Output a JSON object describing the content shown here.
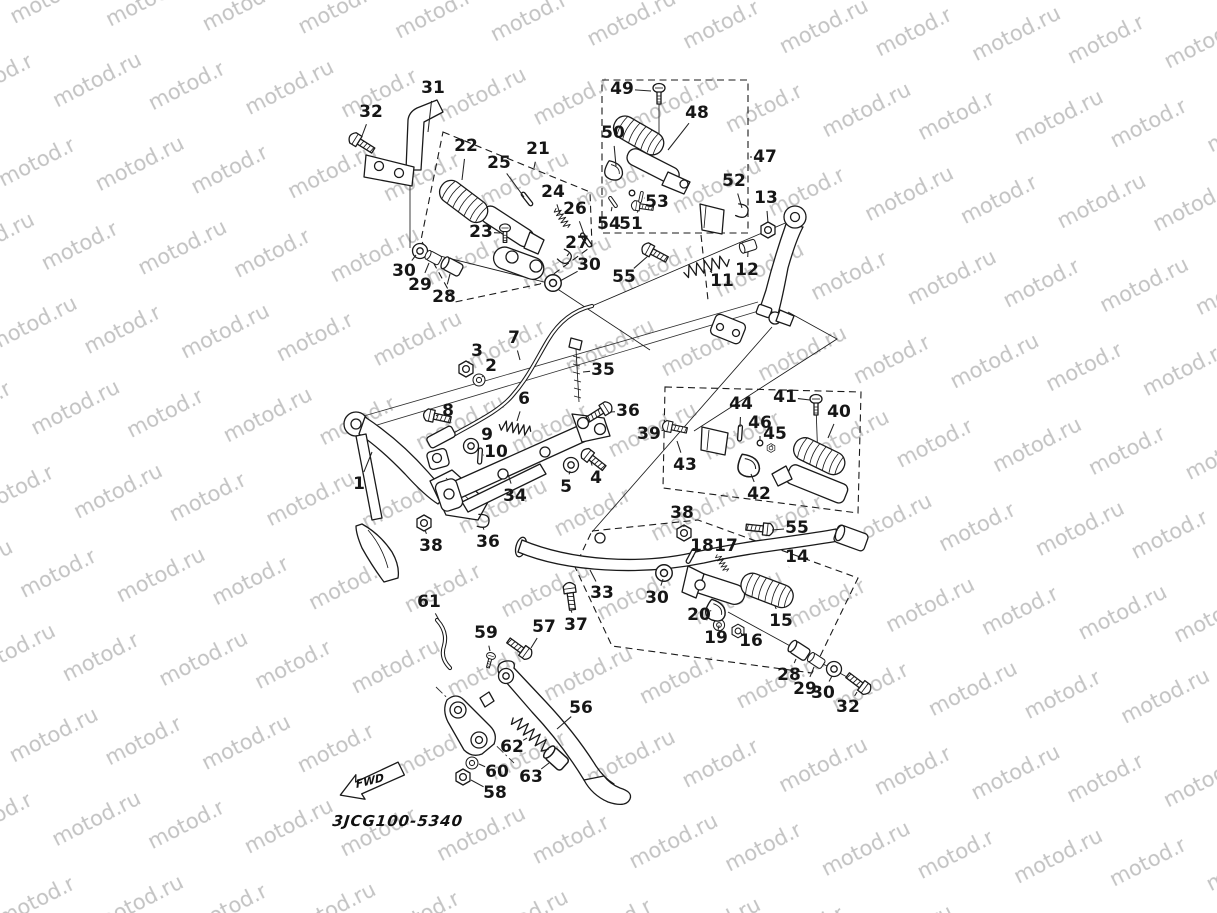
{
  "meta": {
    "description": "Exploded motorcycle parts diagram: stand and footrest assembly",
    "canvas_width": 1217,
    "canvas_height": 913
  },
  "watermark": {
    "text": "motod.ru",
    "color": "#c3c3c3"
  },
  "footer": {
    "drawing_code": "3JCG100-5340",
    "fwd_label": "FWD"
  },
  "diagram": {
    "callouts": [
      {
        "id": "31",
        "n": "31",
        "x": 433,
        "y": 88,
        "tx": 428,
        "ty": 132
      },
      {
        "id": "32a",
        "n": "32",
        "x": 371,
        "y": 112,
        "tx": 362,
        "ty": 136
      },
      {
        "id": "49",
        "n": "49",
        "x": 622,
        "y": 89,
        "tx": 651,
        "ty": 91
      },
      {
        "id": "48",
        "n": "48",
        "x": 697,
        "y": 113,
        "tx": 668,
        "ty": 150
      },
      {
        "id": "50",
        "n": "50",
        "x": 613,
        "y": 133,
        "tx": 616,
        "ty": 166
      },
      {
        "id": "47",
        "n": "47",
        "x": 765,
        "y": 157,
        "tx": 750,
        "ty": 157
      },
      {
        "id": "22",
        "n": "22",
        "x": 466,
        "y": 146,
        "tx": 462,
        "ty": 180
      },
      {
        "id": "25",
        "n": "25",
        "x": 499,
        "y": 163,
        "tx": 524,
        "ty": 197
      },
      {
        "id": "21",
        "n": "21",
        "x": 538,
        "y": 149,
        "tx": 534,
        "ty": 168
      },
      {
        "id": "24",
        "n": "24",
        "x": 553,
        "y": 192,
        "tx": 560,
        "ty": 214
      },
      {
        "id": "26",
        "n": "26",
        "x": 575,
        "y": 209,
        "tx": 585,
        "ty": 237
      },
      {
        "id": "52",
        "n": "52",
        "x": 734,
        "y": 181,
        "tx": 742,
        "ty": 208
      },
      {
        "id": "13",
        "n": "13",
        "x": 766,
        "y": 198,
        "tx": 768,
        "ty": 223
      },
      {
        "id": "53",
        "n": "53",
        "x": 657,
        "y": 202,
        "tx": 644,
        "ty": 198
      },
      {
        "id": "54",
        "n": "54",
        "x": 609,
        "y": 224,
        "tx": 612,
        "ty": 207
      },
      {
        "id": "51",
        "n": "51",
        "x": 631,
        "y": 224,
        "tx": 638,
        "ty": 211
      },
      {
        "id": "23",
        "n": "23",
        "x": 481,
        "y": 232,
        "tx": 500,
        "ty": 233
      },
      {
        "id": "27",
        "n": "27",
        "x": 577,
        "y": 243,
        "tx": 567,
        "ty": 256
      },
      {
        "id": "30a",
        "n": "30",
        "x": 404,
        "y": 271,
        "tx": 416,
        "ty": 255
      },
      {
        "id": "29a",
        "n": "29",
        "x": 420,
        "y": 285,
        "tx": 429,
        "ty": 263
      },
      {
        "id": "28a",
        "n": "28",
        "x": 444,
        "y": 297,
        "tx": 450,
        "ty": 274
      },
      {
        "id": "30b",
        "n": "30",
        "x": 589,
        "y": 265,
        "tx": 560,
        "ty": 281
      },
      {
        "id": "55a",
        "n": "55",
        "x": 624,
        "y": 277,
        "tx": 648,
        "ty": 256
      },
      {
        "id": "11",
        "n": "11",
        "x": 722,
        "y": 281,
        "tx": 710,
        "ty": 271
      },
      {
        "id": "12",
        "n": "12",
        "x": 747,
        "y": 270,
        "tx": 748,
        "ty": 252
      },
      {
        "id": "3",
        "n": "3",
        "x": 477,
        "y": 351,
        "tx": 468,
        "ty": 363
      },
      {
        "id": "2",
        "n": "2",
        "x": 491,
        "y": 366,
        "tx": 482,
        "ty": 377
      },
      {
        "id": "7",
        "n": "7",
        "x": 514,
        "y": 338,
        "tx": 520,
        "ty": 360
      },
      {
        "id": "35",
        "n": "35",
        "x": 603,
        "y": 370,
        "tx": 583,
        "ty": 372
      },
      {
        "id": "8",
        "n": "8",
        "x": 448,
        "y": 411,
        "tx": 438,
        "ty": 415
      },
      {
        "id": "6",
        "n": "6",
        "x": 524,
        "y": 399,
        "tx": 517,
        "ty": 421
      },
      {
        "id": "36a",
        "n": "36",
        "x": 628,
        "y": 411,
        "tx": 610,
        "ty": 412
      },
      {
        "id": "9",
        "n": "9",
        "x": 487,
        "y": 435,
        "tx": 477,
        "ty": 443
      },
      {
        "id": "10",
        "n": "10",
        "x": 496,
        "y": 452,
        "tx": 484,
        "ty": 455
      },
      {
        "id": "44",
        "n": "44",
        "x": 741,
        "y": 404,
        "tx": 740,
        "ty": 427
      },
      {
        "id": "41",
        "n": "41",
        "x": 785,
        "y": 397,
        "tx": 810,
        "ty": 400
      },
      {
        "id": "40",
        "n": "40",
        "x": 839,
        "y": 412,
        "tx": 828,
        "ty": 438
      },
      {
        "id": "39",
        "n": "39",
        "x": 649,
        "y": 434,
        "tx": 664,
        "ty": 430
      },
      {
        "id": "46",
        "n": "46",
        "x": 760,
        "y": 423,
        "tx": 760,
        "ty": 440
      },
      {
        "id": "45",
        "n": "45",
        "x": 775,
        "y": 434,
        "tx": 772,
        "ty": 445
      },
      {
        "id": "43",
        "n": "43",
        "x": 685,
        "y": 465,
        "tx": 677,
        "ty": 441
      },
      {
        "id": "42",
        "n": "42",
        "x": 759,
        "y": 494,
        "tx": 751,
        "ty": 474
      },
      {
        "id": "1",
        "n": "1",
        "x": 359,
        "y": 484,
        "tx": 372,
        "ty": 452
      },
      {
        "id": "34",
        "n": "34",
        "x": 515,
        "y": 496,
        "tx": 508,
        "ty": 474
      },
      {
        "id": "5",
        "n": "5",
        "x": 566,
        "y": 487,
        "tx": 570,
        "ty": 471
      },
      {
        "id": "4",
        "n": "4",
        "x": 596,
        "y": 478,
        "tx": 591,
        "ty": 462
      },
      {
        "id": "38a",
        "n": "38",
        "x": 431,
        "y": 546,
        "tx": 425,
        "ty": 530
      },
      {
        "id": "36b",
        "n": "36",
        "x": 488,
        "y": 542,
        "tx": 483,
        "ty": 527
      },
      {
        "id": "38b",
        "n": "38",
        "x": 682,
        "y": 513,
        "tx": 684,
        "ty": 527
      },
      {
        "id": "55b",
        "n": "55",
        "x": 797,
        "y": 528,
        "tx": 772,
        "ty": 530
      },
      {
        "id": "33",
        "n": "33",
        "x": 602,
        "y": 593,
        "tx": 590,
        "ty": 570
      },
      {
        "id": "30c",
        "n": "30",
        "x": 657,
        "y": 598,
        "tx": 663,
        "ty": 579
      },
      {
        "id": "18",
        "n": "18",
        "x": 702,
        "y": 546,
        "tx": 693,
        "ty": 557
      },
      {
        "id": "17",
        "n": "17",
        "x": 726,
        "y": 546,
        "tx": 723,
        "ty": 558
      },
      {
        "id": "14",
        "n": "14",
        "x": 797,
        "y": 557,
        "tx": 789,
        "ty": 567
      },
      {
        "id": "15",
        "n": "15",
        "x": 781,
        "y": 621,
        "tx": 775,
        "ty": 606
      },
      {
        "id": "20",
        "n": "20",
        "x": 699,
        "y": 615,
        "tx": 710,
        "ty": 611
      },
      {
        "id": "19",
        "n": "19",
        "x": 716,
        "y": 638,
        "tx": 718,
        "ty": 630
      },
      {
        "id": "16",
        "n": "16",
        "x": 751,
        "y": 641,
        "tx": 742,
        "ty": 634
      },
      {
        "id": "61",
        "n": "61",
        "x": 429,
        "y": 602,
        "tx": 439,
        "ty": 620
      },
      {
        "id": "59",
        "n": "59",
        "x": 486,
        "y": 633,
        "tx": 490,
        "ty": 651
      },
      {
        "id": "57",
        "n": "57",
        "x": 544,
        "y": 627,
        "tx": 531,
        "ty": 648
      },
      {
        "id": "37",
        "n": "37",
        "x": 576,
        "y": 625,
        "tx": 571,
        "ty": 610
      },
      {
        "id": "28b",
        "n": "28",
        "x": 789,
        "y": 675,
        "tx": 796,
        "ty": 659
      },
      {
        "id": "29b",
        "n": "29",
        "x": 805,
        "y": 689,
        "tx": 814,
        "ty": 667
      },
      {
        "id": "30d",
        "n": "30",
        "x": 823,
        "y": 693,
        "tx": 832,
        "ty": 676
      },
      {
        "id": "32b",
        "n": "32",
        "x": 848,
        "y": 707,
        "tx": 857,
        "ty": 692
      },
      {
        "id": "56",
        "n": "56",
        "x": 581,
        "y": 708,
        "tx": 557,
        "ty": 729
      },
      {
        "id": "62",
        "n": "62",
        "x": 512,
        "y": 747,
        "tx": 527,
        "ty": 738
      },
      {
        "id": "63",
        "n": "63",
        "x": 531,
        "y": 777,
        "tx": 549,
        "ty": 763
      },
      {
        "id": "60",
        "n": "60",
        "x": 497,
        "y": 772,
        "tx": 479,
        "ty": 764
      },
      {
        "id": "58",
        "n": "58",
        "x": 495,
        "y": 793,
        "tx": 471,
        "ty": 780
      }
    ],
    "parts": [
      {
        "t": "bolt",
        "x": 358,
        "y": 141,
        "r": 32,
        "name": "bolt-32"
      },
      {
        "t": "bolt",
        "x": 651,
        "y": 251,
        "r": 28,
        "name": "bolt-55"
      },
      {
        "t": "bolt",
        "x": 433,
        "y": 416,
        "r": 12,
        "name": "bolt-8"
      },
      {
        "t": "bolt",
        "x": 603,
        "y": 410,
        "r": 148,
        "name": "flange-bolt-36"
      },
      {
        "t": "bolt",
        "x": 590,
        "y": 457,
        "r": 38,
        "name": "bolt-4"
      },
      {
        "t": "bolt",
        "x": 764,
        "y": 529,
        "r": 186,
        "name": "bolt-55-rear"
      },
      {
        "t": "bolt",
        "x": 523,
        "y": 651,
        "r": 216,
        "name": "pivot-bolt-57"
      },
      {
        "t": "bolt",
        "x": 570,
        "y": 592,
        "r": 82,
        "name": "bolt-37"
      },
      {
        "t": "bolt",
        "x": 862,
        "y": 686,
        "r": 217,
        "name": "bolt-32-rear"
      },
      {
        "t": "bolt",
        "x": 639,
        "y": 206,
        "r": 8,
        "s": 0.8,
        "name": "bolt-51"
      },
      {
        "t": "bolt",
        "x": 671,
        "y": 427,
        "r": 12,
        "s": 0.9,
        "name": "joint-pin-39"
      },
      {
        "t": "screw",
        "x": 659,
        "y": 88,
        "name": "screw-49"
      },
      {
        "t": "screw",
        "x": 816,
        "y": 399,
        "name": "screw-41"
      },
      {
        "t": "screw",
        "x": 505,
        "y": 228,
        "s": 0.9,
        "name": "bolt-23"
      },
      {
        "t": "screw",
        "x": 491,
        "y": 656,
        "s": 0.75,
        "r": 15,
        "name": "screw-59"
      },
      {
        "t": "nut",
        "x": 466,
        "y": 369,
        "name": "nut-3"
      },
      {
        "t": "nut",
        "x": 768,
        "y": 230,
        "name": "nut-13"
      },
      {
        "t": "nut",
        "x": 424,
        "y": 523,
        "name": "nut-38"
      },
      {
        "t": "nut",
        "x": 684,
        "y": 533,
        "name": "nut-38-rear"
      },
      {
        "t": "nut",
        "x": 463,
        "y": 777,
        "name": "nut-58"
      },
      {
        "t": "nut",
        "x": 738,
        "y": 631,
        "s": 0.85,
        "name": "nut-16"
      },
      {
        "t": "nut",
        "x": 771,
        "y": 448,
        "s": 0.55,
        "name": "nut-45"
      },
      {
        "t": "washer",
        "x": 479,
        "y": 380,
        "s": 0.8,
        "name": "washer-2"
      },
      {
        "t": "washer",
        "x": 471,
        "y": 446,
        "name": "washer-9"
      },
      {
        "t": "washer",
        "x": 420,
        "y": 251,
        "name": "washer-30-front"
      },
      {
        "t": "washer",
        "x": 553,
        "y": 283,
        "s": 1.1,
        "name": "washer-30-mid"
      },
      {
        "t": "washer",
        "x": 664,
        "y": 573,
        "s": 1.1,
        "name": "washer-30-rear"
      },
      {
        "t": "washer",
        "x": 834,
        "y": 669,
        "name": "washer-30-right"
      },
      {
        "t": "washer",
        "x": 719,
        "y": 625,
        "s": 0.75,
        "name": "washer-19"
      },
      {
        "t": "washer",
        "x": 472,
        "y": 763,
        "s": 0.8,
        "name": "washer-60"
      },
      {
        "t": "washer",
        "x": 571,
        "y": 465,
        "name": "washer-5"
      },
      {
        "t": "bush",
        "x": 453,
        "y": 267,
        "r": 28,
        "name": "bushing-28"
      },
      {
        "t": "bush",
        "x": 434,
        "y": 258,
        "r": 28,
        "s": 0.75,
        "name": "collar-29"
      },
      {
        "t": "bush",
        "x": 800,
        "y": 651,
        "r": 33,
        "name": "bushing-28-rear"
      },
      {
        "t": "bush",
        "x": 817,
        "y": 661,
        "r": 33,
        "s": 0.8,
        "name": "collar-29-rear"
      },
      {
        "t": "bush",
        "x": 749,
        "y": 246,
        "r": -18,
        "s": 0.8,
        "name": "collar-12"
      },
      {
        "t": "bush",
        "x": 557,
        "y": 759,
        "r": 42,
        "s": 1.15,
        "name": "spring-cover-63"
      },
      {
        "t": "spring",
        "x": 562,
        "y": 218,
        "r": 58,
        "s": 0.7,
        "name": "spring-24"
      },
      {
        "t": "spring",
        "x": 515,
        "y": 428,
        "r": 12,
        "name": "return-spring-6"
      },
      {
        "t": "spring",
        "x": 722,
        "y": 563,
        "r": 60,
        "s": 0.6,
        "name": "spring-17"
      },
      {
        "t": "springlg",
        "x": 531,
        "y": 734,
        "r": 42,
        "name": "stand-spring-62"
      },
      {
        "t": "springlg",
        "x": 707,
        "y": 266,
        "r": -16,
        "name": "spring-11"
      },
      {
        "t": "pin",
        "x": 527,
        "y": 199,
        "r": -38,
        "name": "pin-25"
      },
      {
        "t": "pin",
        "x": 586,
        "y": 240,
        "r": -35,
        "name": "pin-26"
      },
      {
        "t": "pin",
        "x": 480,
        "y": 456,
        "r": 4,
        "name": "pin-10"
      },
      {
        "t": "pin",
        "x": 691,
        "y": 556,
        "r": 28,
        "name": "pin-18"
      },
      {
        "t": "pin",
        "x": 740,
        "y": 433,
        "r": 4,
        "name": "pin-44"
      },
      {
        "t": "pin",
        "x": 613,
        "y": 202,
        "r": -35,
        "s": 0.8,
        "name": "pin-54"
      },
      {
        "t": "pin",
        "x": 641,
        "y": 197,
        "r": 12,
        "s": 0.7,
        "name": "pin-53"
      },
      {
        "t": "ball",
        "x": 632,
        "y": 193,
        "name": "ball-53"
      },
      {
        "t": "ball",
        "x": 760,
        "y": 443,
        "name": "bolt-46"
      },
      {
        "t": "clip",
        "x": 565,
        "y": 257,
        "r": 35,
        "name": "clip-27"
      },
      {
        "t": "clip",
        "x": 483,
        "y": 521,
        "r": 8,
        "name": "clip-36"
      },
      {
        "t": "clip",
        "x": 742,
        "y": 211,
        "r": 15,
        "name": "clip-52"
      },
      {
        "t": "pad",
        "x": 614,
        "y": 171,
        "r": 20,
        "name": "pad-50"
      },
      {
        "t": "pad",
        "x": 749,
        "y": 466,
        "r": 15,
        "s": 1.2,
        "name": "pad-42"
      },
      {
        "t": "pad",
        "x": 716,
        "y": 611,
        "r": 25,
        "s": 1.1,
        "name": "bracket-20"
      },
      {
        "t": "peg",
        "x": 449,
        "y": 176,
        "r": 37,
        "name": "footrest-rubber-22"
      },
      {
        "t": "peg",
        "x": 621,
        "y": 112,
        "r": 30,
        "name": "footrest-rubber-48"
      },
      {
        "t": "peg",
        "x": 800,
        "y": 434,
        "r": 26,
        "name": "footrest-rubber-40"
      },
      {
        "t": "peg",
        "x": 746,
        "y": 570,
        "r": 21,
        "name": "footrest-rubber-15"
      }
    ]
  }
}
